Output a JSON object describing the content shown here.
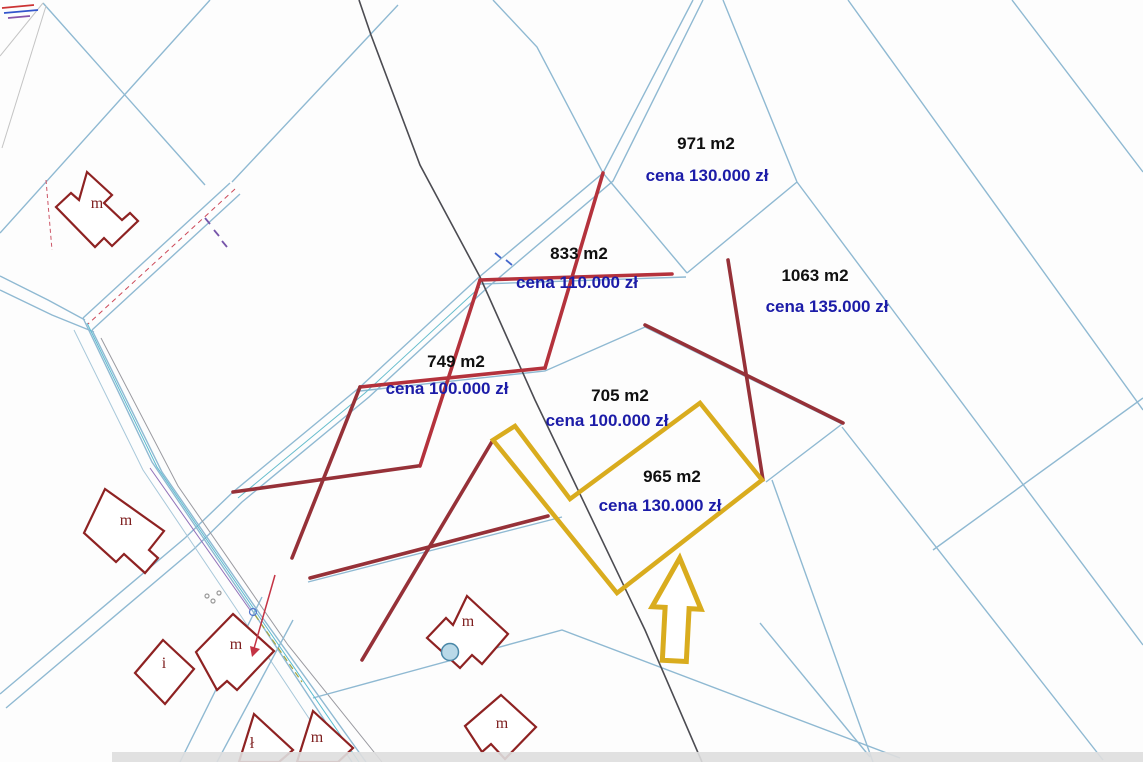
{
  "map": {
    "colors": {
      "background": "#fdfdfd",
      "parcel_line": "#8fb9d2",
      "road_cyan": "#5bbcd0",
      "black_line": "#4c4c52",
      "highlight_yellow": "#d9ac1e",
      "cross_bright_red": "#b4323c",
      "cross_dark_red": "#963138",
      "house_outline": "#8e2222",
      "area_text": "#101010",
      "price_text": "#1c1ca8",
      "pond_fill": "#b9d9e8",
      "pond_stroke": "#4a88a8",
      "edge_band": "#dedede"
    },
    "parcels": [
      {
        "area": "971 m2",
        "price": "cena 130.000 zł",
        "area_pos": [
          706,
          149
        ],
        "price_pos": [
          707,
          181
        ]
      },
      {
        "area": "833 m2",
        "price": "cena 110.000 zł",
        "area_pos": [
          579,
          259
        ],
        "price_pos": [
          577,
          288
        ]
      },
      {
        "area": "1063 m2",
        "price": "cena 135.000 zł",
        "area_pos": [
          815,
          281
        ],
        "price_pos": [
          827,
          312
        ]
      },
      {
        "area": "749 m2",
        "price": "cena 100.000 zł",
        "area_pos": [
          456,
          367
        ],
        "price_pos": [
          447,
          394
        ]
      },
      {
        "area": "705 m2",
        "price": "cena 100.000 zł",
        "area_pos": [
          620,
          401
        ],
        "price_pos": [
          607,
          426
        ]
      },
      {
        "area": "965 m2",
        "price": "cena 130.000 zł",
        "area_pos": [
          672,
          482
        ],
        "price_pos": [
          660,
          511
        ]
      }
    ],
    "highlight_plot": {
      "polygon": "493,440 515,426 570,499 700,403 762,480 617,593",
      "arrow_path": "M677,558 L701,608 L689,608 L689,661 L665,661 L665,608 L652,608 Z",
      "arrow_rotation": "rotate(3 677 610)"
    },
    "cross_marks": [
      {
        "points": [
          [
            603,
            173
          ],
          [
            545,
            368
          ]
        ],
        "tone": "bright"
      },
      {
        "points": [
          [
            480,
            280
          ],
          [
            672,
            274
          ]
        ],
        "tone": "bright"
      },
      {
        "points": [
          [
            360,
            387
          ],
          [
            545,
            368
          ]
        ],
        "tone": "bright"
      },
      {
        "points": [
          [
            480,
            280
          ],
          [
            420,
            466
          ]
        ],
        "tone": "bright"
      },
      {
        "points": [
          [
            360,
            387
          ],
          [
            292,
            558
          ]
        ],
        "tone": "dark"
      },
      {
        "points": [
          [
            233,
            492
          ],
          [
            418,
            466
          ]
        ],
        "tone": "dark"
      },
      {
        "points": [
          [
            310,
            578
          ],
          [
            548,
            516
          ]
        ],
        "tone": "dark"
      },
      {
        "points": [
          [
            493,
            440
          ],
          [
            362,
            660
          ]
        ],
        "tone": "dark"
      },
      {
        "points": [
          [
            728,
            260
          ],
          [
            763,
            480
          ]
        ],
        "tone": "dark"
      },
      {
        "points": [
          [
            645,
            325
          ],
          [
            843,
            423
          ]
        ],
        "tone": "dark"
      }
    ],
    "boundary_lines": [
      {
        "points": [
          [
            43,
            3
          ],
          [
            205,
            185
          ]
        ]
      },
      {
        "points": [
          [
            210,
            0
          ],
          [
            0,
            233
          ]
        ]
      },
      {
        "points": [
          [
            398,
            5
          ],
          [
            232,
            182
          ]
        ]
      },
      {
        "points": [
          [
            493,
            0
          ],
          [
            537,
            47
          ],
          [
            603,
            173
          ]
        ]
      },
      {
        "points": [
          [
            693,
            0
          ],
          [
            603,
            173
          ],
          [
            478,
            278
          ],
          [
            360,
            387
          ],
          [
            233,
            492
          ],
          [
            185,
            538
          ],
          [
            0,
            694
          ]
        ]
      },
      {
        "points": [
          [
            703,
            0
          ],
          [
            613,
            181
          ],
          [
            487,
            288
          ],
          [
            369,
            397
          ],
          [
            242,
            502
          ],
          [
            194,
            549
          ],
          [
            6,
            708
          ]
        ]
      },
      {
        "points": [
          [
            603,
            173
          ],
          [
            687,
            273
          ]
        ]
      },
      {
        "points": [
          [
            687,
            273
          ],
          [
            797,
            182
          ]
        ]
      },
      {
        "points": [
          [
            723,
            0
          ],
          [
            797,
            182
          ]
        ]
      },
      {
        "points": [
          [
            797,
            182
          ],
          [
            1143,
            645
          ]
        ]
      },
      {
        "points": [
          [
            848,
            0
          ],
          [
            1143,
            410
          ]
        ]
      },
      {
        "points": [
          [
            1012,
            0
          ],
          [
            1143,
            172
          ]
        ]
      },
      {
        "points": [
          [
            480,
            284
          ],
          [
            686,
            277
          ]
        ]
      },
      {
        "points": [
          [
            360,
            391
          ],
          [
            545,
            371
          ],
          [
            645,
            327
          ],
          [
            842,
            424
          ],
          [
            766,
            482
          ]
        ]
      },
      {
        "points": [
          [
            308,
            582
          ],
          [
            562,
            517
          ]
        ]
      },
      {
        "points": [
          [
            230,
            183
          ],
          [
            83,
            318
          ]
        ]
      },
      {
        "points": [
          [
            240,
            194
          ],
          [
            92,
            330
          ]
        ]
      },
      {
        "points": [
          [
            0,
            276
          ],
          [
            48,
            300
          ],
          [
            85,
            320
          ]
        ]
      },
      {
        "points": [
          [
            0,
            290
          ],
          [
            52,
            315
          ],
          [
            94,
            332
          ]
        ]
      },
      {
        "points": [
          [
            83,
            318
          ],
          [
            152,
            462
          ],
          [
            250,
            607
          ],
          [
            352,
            762
          ]
        ]
      },
      {
        "points": [
          [
            92,
            330
          ],
          [
            162,
            472
          ],
          [
            262,
            617
          ],
          [
            366,
            762
          ]
        ]
      },
      {
        "points": [
          [
            101,
            338
          ],
          [
            178,
            486
          ],
          [
            288,
            645
          ],
          [
            382,
            762
          ]
        ],
        "color": "#9a9aa0",
        "width": 1
      },
      {
        "points": [
          [
            74,
            330
          ],
          [
            143,
            470
          ],
          [
            235,
            607
          ],
          [
            338,
            762
          ]
        ],
        "color": "#a8c8da",
        "width": 1
      },
      {
        "points": [
          [
            293,
            620
          ],
          [
            217,
            762
          ]
        ]
      },
      {
        "points": [
          [
            262,
            597
          ],
          [
            180,
            762
          ]
        ]
      },
      {
        "points": [
          [
            313,
            698
          ],
          [
            562,
            630
          ],
          [
            900,
            758
          ]
        ]
      },
      {
        "points": [
          [
            772,
            480
          ],
          [
            873,
            762
          ]
        ]
      },
      {
        "points": [
          [
            842,
            427
          ],
          [
            1103,
            760
          ]
        ]
      },
      {
        "points": [
          [
            1143,
            398
          ],
          [
            933,
            550
          ]
        ]
      },
      {
        "points": [
          [
            760,
            623
          ],
          [
            870,
            757
          ]
        ]
      },
      {
        "points": [
          [
            87,
            323
          ],
          [
            157,
            467
          ],
          [
            256,
            612
          ],
          [
            359,
            762
          ]
        ],
        "color": "#5bbcd0",
        "width": 1
      },
      {
        "points": [
          [
            480,
            287
          ],
          [
            365,
            393
          ],
          [
            238,
            498
          ]
        ],
        "color": "#66bccc",
        "width": 1
      },
      {
        "points": [
          [
            235,
            189
          ],
          [
            88,
            324
          ]
        ],
        "color": "#cc4858",
        "width": 1,
        "dash": "5,4"
      },
      {
        "points": [
          [
            46,
            180
          ],
          [
            52,
            250
          ]
        ],
        "color": "#cc5566",
        "width": 1,
        "dash": "4,3"
      },
      {
        "points": [
          [
            43,
            3
          ],
          [
            0,
            56
          ]
        ],
        "color": "#c4c4c4",
        "width": 1
      },
      {
        "points": [
          [
            46,
            6
          ],
          [
            2,
            148
          ]
        ],
        "color": "#c4c4c4",
        "width": 1
      },
      {
        "points": [
          [
            255,
            615
          ],
          [
            302,
            682
          ]
        ],
        "color": "#a0a640",
        "width": 1.2,
        "dash": "6,4"
      },
      {
        "points": [
          [
            150,
            468
          ],
          [
            250,
            610
          ]
        ],
        "color": "#9070b8",
        "width": 1
      }
    ],
    "black_line": {
      "points": [
        [
          359,
          0
        ],
        [
          371,
          35
        ],
        [
          420,
          165
        ],
        [
          480,
          277
        ],
        [
          535,
          400
        ],
        [
          645,
          630
        ],
        [
          702,
          762
        ]
      ]
    },
    "houses": [
      {
        "label": "m",
        "label_pos": [
          97,
          208
        ],
        "path": "M87,172 L112,195 L104,203 L122,220 L130,213 L138,221 L112,246 L104,238 L95,247 L56,207 L71,193 L79,200 Z"
      },
      {
        "label": "m",
        "label_pos": [
          126,
          525
        ],
        "path": "M105,489 L164,531 L149,550 L158,558 L145,573 L124,554 L116,562 L84,533 Z"
      },
      {
        "label": "i",
        "label_pos": [
          164,
          668
        ],
        "path": "M163,640 L194,669 L165,704 L135,673 Z"
      },
      {
        "label": "m",
        "label_pos": [
          236,
          649
        ],
        "path": "M233,614 L274,651 L237,690 L227,681 L217,690 L196,652 Z"
      },
      {
        "label": "m",
        "label_pos": [
          468,
          626
        ],
        "path": "M467,596 L508,634 L482,664 L472,655 L460,668 L427,638 L446,618 L453,625 Z",
        "circle": [
          450,
          652,
          8.5
        ]
      },
      {
        "label": "m",
        "label_pos": [
          502,
          728
        ],
        "path": "M501,695 L536,727 L505,759 L491,744 L482,752 L465,726 Z"
      },
      {
        "label": "ł",
        "label_pos": [
          252,
          748
        ],
        "path": "M254,714 L293,750 L279,762 L239,762 Z"
      },
      {
        "label": "m",
        "label_pos": [
          317,
          742
        ],
        "path": "M313,711 L353,748 L338,762 L297,762 Z"
      }
    ],
    "small_arrow": {
      "line": [
        [
          275,
          575
        ],
        [
          253,
          652
        ]
      ],
      "head": "252,657 260,649 250,646"
    },
    "symbols": [
      {
        "type": "circle",
        "cx": 253,
        "cy": 612,
        "r": 3.5,
        "stroke": "#5577cc"
      },
      {
        "type": "circle",
        "cx": 207,
        "cy": 596,
        "r": 2,
        "stroke": "#999999"
      },
      {
        "type": "circle",
        "cx": 213,
        "cy": 601,
        "r": 2,
        "stroke": "#999999"
      },
      {
        "type": "circle",
        "cx": 219,
        "cy": 593,
        "r": 2,
        "stroke": "#999999"
      },
      {
        "type": "line",
        "points": [
          [
            205,
            218
          ],
          [
            210,
            224
          ]
        ],
        "stroke": "#7755aa"
      },
      {
        "type": "line",
        "points": [
          [
            214,
            230
          ],
          [
            219,
            236
          ]
        ],
        "stroke": "#7755aa"
      },
      {
        "type": "line",
        "points": [
          [
            222,
            241
          ],
          [
            227,
            247
          ]
        ],
        "stroke": "#7755aa"
      },
      {
        "type": "line",
        "points": [
          [
            2,
            8
          ],
          [
            34,
            5
          ]
        ],
        "stroke": "#cc3333"
      },
      {
        "type": "line",
        "points": [
          [
            4,
            13
          ],
          [
            38,
            10
          ]
        ],
        "stroke": "#3355cc"
      },
      {
        "type": "line",
        "points": [
          [
            8,
            18
          ],
          [
            30,
            16
          ]
        ],
        "stroke": "#8855aa"
      },
      {
        "type": "line",
        "points": [
          [
            495,
            253
          ],
          [
            501,
            258
          ]
        ],
        "stroke": "#4466cc"
      },
      {
        "type": "line",
        "points": [
          [
            506,
            260
          ],
          [
            512,
            265
          ]
        ],
        "stroke": "#4466cc"
      }
    ],
    "edge_band": {
      "x": 112,
      "y": 752,
      "width": 1031,
      "height": 10
    }
  }
}
